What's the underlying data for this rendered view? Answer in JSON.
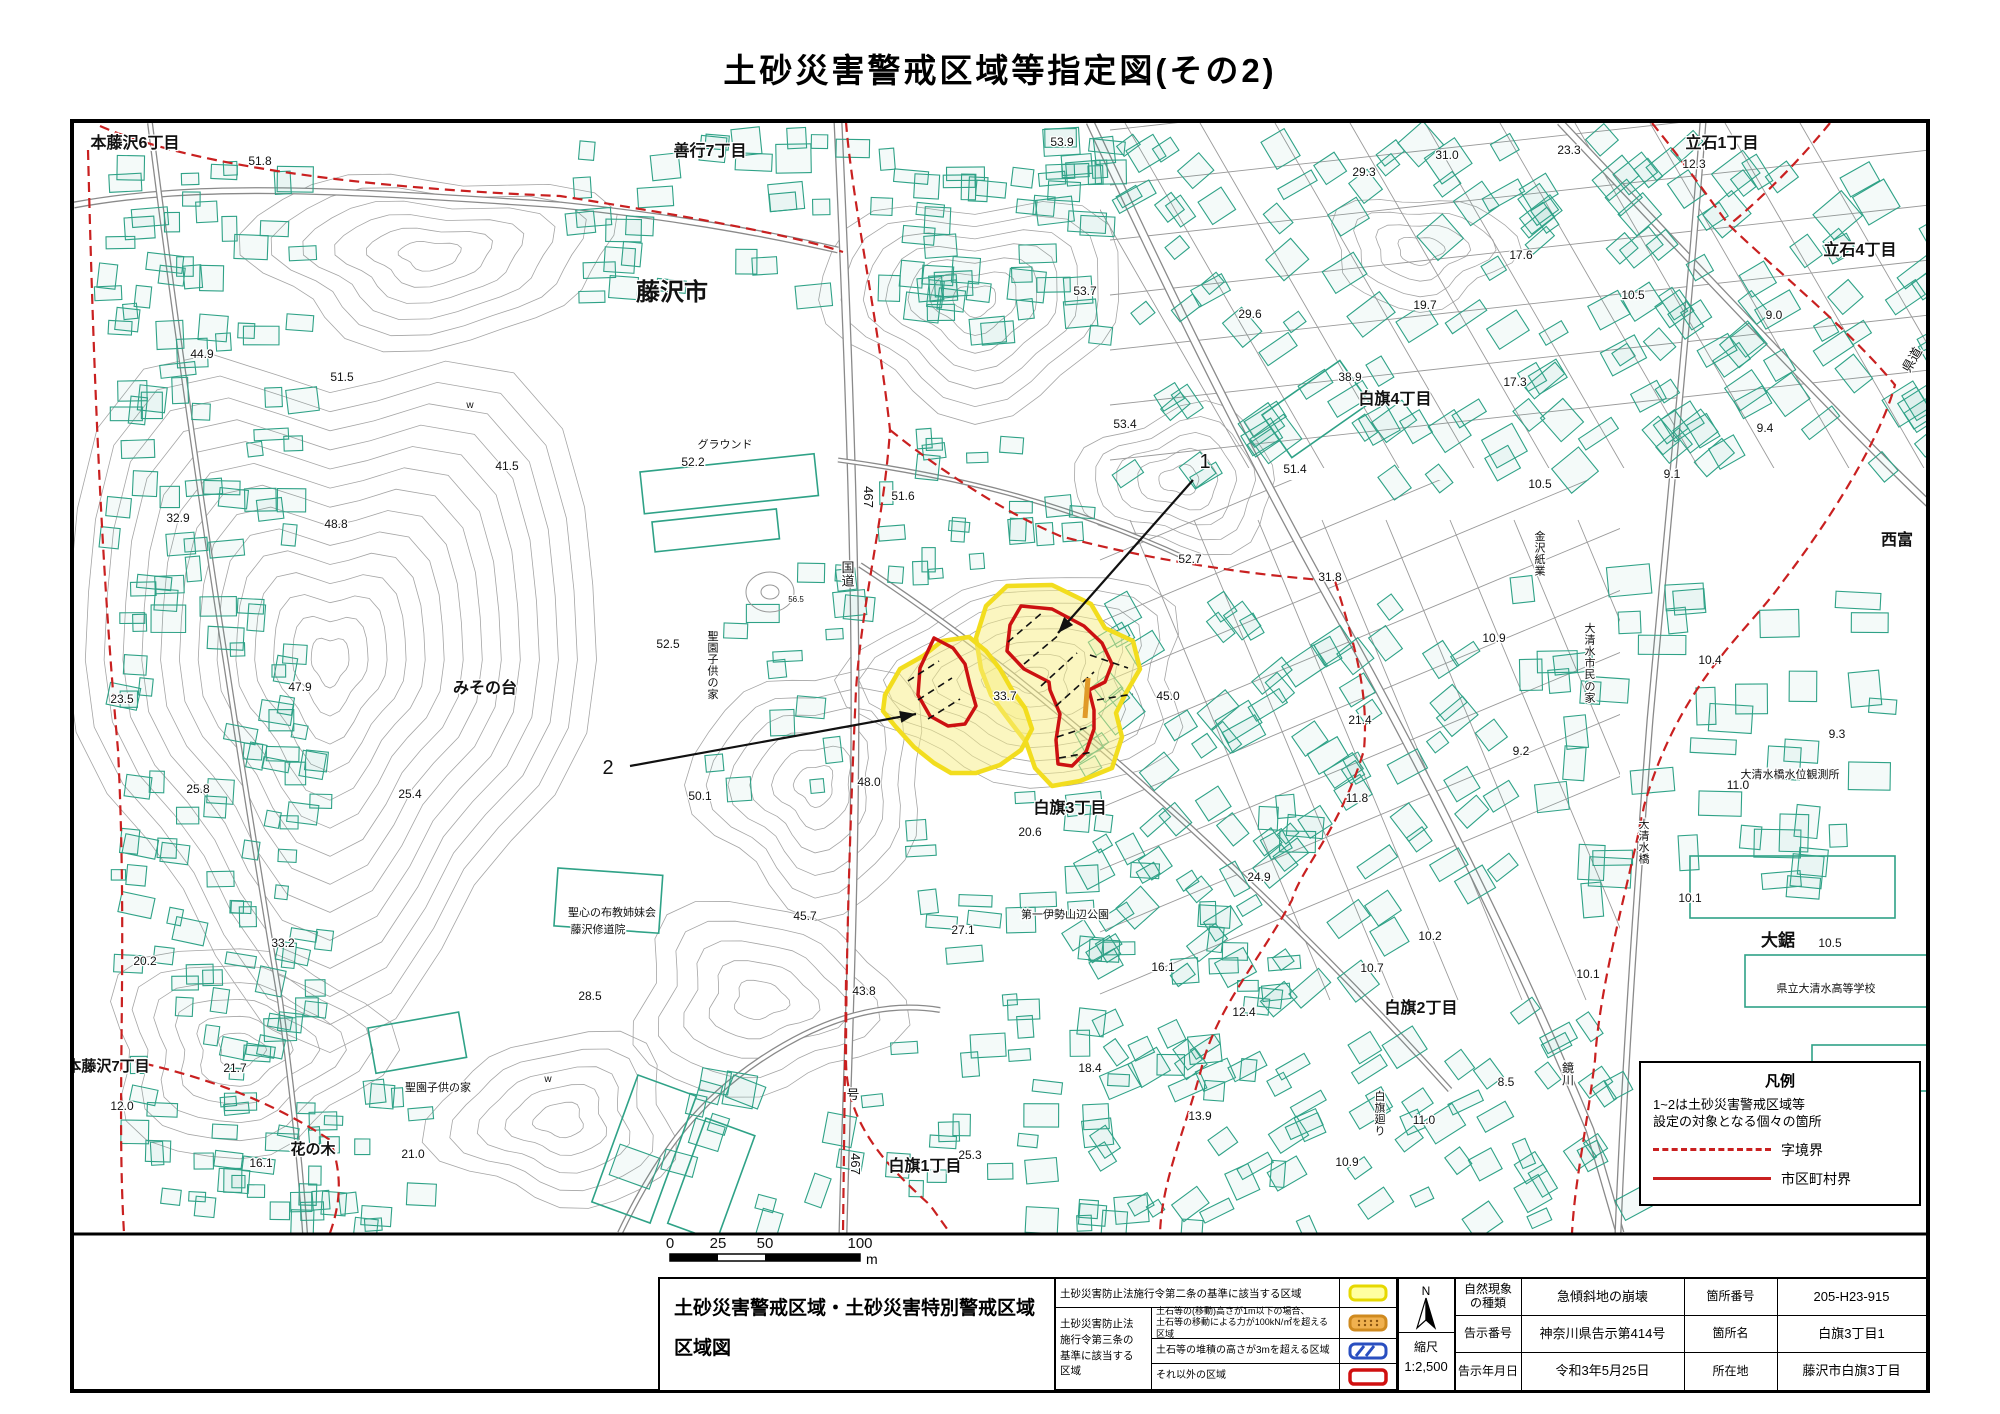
{
  "doc": {
    "title": "土砂災害警戒区域等指定図(その2)"
  },
  "colors": {
    "warning_zone_stroke": "#f2dd1e",
    "warning_zone_fill": "#f7f2c2",
    "special_zone": "#cc1111",
    "boundary_line": "#c92020",
    "building": "#2fa287",
    "contour": "#a5a5a5",
    "road": "#8a8a8a",
    "sediment_mark": "#e09a28",
    "hatch_blue": "#2a4fc0"
  },
  "map": {
    "legend_box": {
      "title": "凡例",
      "note": "1~2は土砂災害警戒区域等\n設定の対象となる個々の箇所",
      "dashed_label": "字境界",
      "solid_label": "市区町村界"
    },
    "scale_bar": {
      "ticks": [
        "0",
        "25",
        "50",
        "100"
      ],
      "unit": "m"
    },
    "texts": [
      {
        "t": "本藤沢6丁目",
        "x": 135,
        "y": 148,
        "s": 16,
        "b": 1
      },
      {
        "t": "善行7丁目",
        "x": 710,
        "y": 156,
        "s": 16,
        "b": 1
      },
      {
        "t": "藤沢市",
        "x": 672,
        "y": 300,
        "s": 24,
        "b": 1
      },
      {
        "t": "立石1丁目",
        "x": 1722,
        "y": 148,
        "s": 16,
        "b": 1
      },
      {
        "t": "立石4丁目",
        "x": 1860,
        "y": 255,
        "s": 16,
        "b": 1
      },
      {
        "t": "白旗4丁目",
        "x": 1395,
        "y": 404,
        "s": 16,
        "b": 1
      },
      {
        "t": "西富",
        "x": 1897,
        "y": 545,
        "s": 16,
        "b": 1
      },
      {
        "t": "みその台",
        "x": 485,
        "y": 693,
        "s": 16,
        "b": 1
      },
      {
        "t": "白旗3丁目",
        "x": 1070,
        "y": 813,
        "s": 16,
        "b": 1
      },
      {
        "t": "白旗2丁目",
        "x": 1421,
        "y": 1013,
        "s": 16,
        "b": 1
      },
      {
        "t": "白旗1丁目",
        "x": 925,
        "y": 1171,
        "s": 16,
        "b": 1
      },
      {
        "t": "本藤沢7丁目",
        "x": 108,
        "y": 1071,
        "s": 15,
        "b": 1
      },
      {
        "t": "花の木",
        "x": 313,
        "y": 1154,
        "s": 15,
        "b": 1
      },
      {
        "t": "大鋸",
        "x": 1778,
        "y": 946,
        "s": 17,
        "b": 1
      },
      {
        "t": "県道",
        "x": 1916,
        "y": 362,
        "s": 13,
        "r": -60
      },
      {
        "t": "グラウンド",
        "x": 725,
        "y": 448,
        "s": 11
      },
      {
        "t": "聖園子供の家",
        "x": 713,
        "y": 640,
        "s": 11,
        "v": 1
      },
      {
        "t": "聖心の布教姉妹会",
        "x": 612,
        "y": 916,
        "s": 11
      },
      {
        "t": "藤沢修道院",
        "x": 598,
        "y": 933,
        "s": 11
      },
      {
        "t": "聖園子供の家",
        "x": 438,
        "y": 1091,
        "s": 11
      },
      {
        "t": "第一伊勢山辺公園",
        "x": 1065,
        "y": 918,
        "s": 11
      },
      {
        "t": "白旗廻り",
        "x": 1380,
        "y": 1100,
        "s": 11,
        "v": 1
      },
      {
        "t": "金沢紙業",
        "x": 1540,
        "y": 540,
        "s": 11,
        "v": 1
      },
      {
        "t": "大清水市民の家",
        "x": 1590,
        "y": 632,
        "s": 11,
        "v": 1
      },
      {
        "t": "大清水橋水位観測所",
        "x": 1790,
        "y": 778,
        "s": 11
      },
      {
        "t": "大清水橋",
        "x": 1644,
        "y": 828,
        "s": 11,
        "v": 1
      },
      {
        "t": "鏡川",
        "x": 1568,
        "y": 1072,
        "s": 12,
        "v": 1
      },
      {
        "t": "県立大清水高等学校",
        "x": 1826,
        "y": 992,
        "s": 11
      },
      {
        "t": "国道",
        "x": 848,
        "y": 572,
        "s": 13,
        "v": 1
      },
      {
        "t": "467",
        "x": 864,
        "y": 497,
        "s": 13,
        "r": 90
      },
      {
        "t": "号",
        "x": 853,
        "y": 1099,
        "s": 13
      },
      {
        "t": "467",
        "x": 851,
        "y": 1164,
        "s": 13,
        "r": 90
      },
      {
        "t": "w",
        "x": 470,
        "y": 408,
        "s": 10
      },
      {
        "t": "w",
        "x": 548,
        "y": 1082,
        "s": 10
      },
      {
        "t": "56.5",
        "x": 796,
        "y": 602,
        "s": 8
      }
    ],
    "elevations": [
      [
        "51.8",
        260,
        165
      ],
      [
        "53.9",
        1062,
        146
      ],
      [
        "31.0",
        1447,
        159
      ],
      [
        "23.3",
        1569,
        154
      ],
      [
        "12.3",
        1694,
        168
      ],
      [
        "29.3",
        1364,
        176
      ],
      [
        "53.7",
        1085,
        295
      ],
      [
        "29.6",
        1250,
        318
      ],
      [
        "19.7",
        1425,
        309
      ],
      [
        "17.6",
        1521,
        259
      ],
      [
        "10.5",
        1633,
        299
      ],
      [
        "9.0",
        1774,
        319
      ],
      [
        "44.9",
        202,
        358
      ],
      [
        "51.5",
        342,
        381
      ],
      [
        "38.9",
        1350,
        381
      ],
      [
        "17.3",
        1515,
        386
      ],
      [
        "9.4",
        1765,
        432
      ],
      [
        "41.5",
        507,
        470
      ],
      [
        "52.2",
        693,
        466
      ],
      [
        "48.8",
        336,
        528
      ],
      [
        "32.9",
        178,
        522
      ],
      [
        "53.4",
        1125,
        428
      ],
      [
        "51.4",
        1295,
        473
      ],
      [
        "9.1",
        1672,
        478
      ],
      [
        "10.5",
        1540,
        488
      ],
      [
        "51.6",
        903,
        500
      ],
      [
        "52.7",
        1190,
        563
      ],
      [
        "31.8",
        1330,
        581
      ],
      [
        "10.9",
        1494,
        642
      ],
      [
        "10.4",
        1710,
        664
      ],
      [
        "52.5",
        668,
        648
      ],
      [
        "23.5",
        122,
        703
      ],
      [
        "47.9",
        300,
        691
      ],
      [
        "33.7",
        1005,
        700
      ],
      [
        "45.0",
        1168,
        700
      ],
      [
        "21.4",
        1360,
        724
      ],
      [
        "9.3",
        1837,
        738
      ],
      [
        "9.2",
        1521,
        755
      ],
      [
        "11.0",
        1738,
        789
      ],
      [
        "25.8",
        198,
        793
      ],
      [
        "25.4",
        410,
        798
      ],
      [
        "48.0",
        869,
        786
      ],
      [
        "50.1",
        700,
        800
      ],
      [
        "20.6",
        1030,
        836
      ],
      [
        "11.8",
        1357,
        802
      ],
      [
        "24.9",
        1259,
        881
      ],
      [
        "10.1",
        1690,
        902
      ],
      [
        "45.7",
        805,
        920
      ],
      [
        "27.1",
        963,
        934
      ],
      [
        "33.2",
        283,
        947
      ],
      [
        "10.2",
        1430,
        940
      ],
      [
        "10.7",
        1372,
        972
      ],
      [
        "16.1",
        1163,
        971
      ],
      [
        "10.5",
        1830,
        947
      ],
      [
        "10.1",
        1588,
        978
      ],
      [
        "28.5",
        590,
        1000
      ],
      [
        "43.8",
        864,
        995
      ],
      [
        "12.4",
        1244,
        1016
      ],
      [
        "20.2",
        145,
        965
      ],
      [
        "11.0",
        1424,
        1124
      ],
      [
        "8.5",
        1506,
        1086
      ],
      [
        "13.9",
        1200,
        1120
      ],
      [
        "10.9",
        1347,
        1166
      ],
      [
        "21.7",
        235,
        1072
      ],
      [
        "12.0",
        122,
        1110
      ],
      [
        "16.1",
        261,
        1167
      ],
      [
        "21.0",
        413,
        1158
      ],
      [
        "25.3",
        970,
        1159
      ],
      [
        "18.4",
        1090,
        1072
      ]
    ],
    "hazard_points": [
      {
        "label": "1",
        "lx": 1205,
        "ly": 468,
        "x1": 1193,
        "y1": 480,
        "x2": 1058,
        "y2": 633
      },
      {
        "label": "2",
        "lx": 608,
        "ly": 774,
        "x1": 630,
        "y1": 766,
        "x2": 916,
        "y2": 714
      }
    ]
  },
  "footer": {
    "block_title_line1": "土砂災害警戒区域・土砂災害特別警戒区域",
    "block_title_line2": "区域図",
    "legend": {
      "row1_label": "土砂災害防止法施行令第二条の基準に該当する区域",
      "group_label": "土砂災害防止法\n施行令第三条の\n基準に該当する\n区域",
      "row2_label": "土石等の(移動)高さが1m以下の場合、\n土石等の移動による力が100kN/㎡を超える区域",
      "row3_label": "土石等の堆積の高さが3mを超える区域",
      "row4_label": "それ以外の区域"
    },
    "compass": {
      "north": "N",
      "scale_label": "縮尺",
      "scale_value": "1:2,500"
    },
    "info": {
      "rows": [
        {
          "label1": "自然現象\nの種類",
          "value1": "急傾斜地の崩壊",
          "label2": "箇所番号",
          "value2": "205-H23-915"
        },
        {
          "label1": "告示番号",
          "value1": "神奈川県告示第414号",
          "label2": "箇所名",
          "value2": "白旗3丁目1"
        },
        {
          "label1": "告示年月日",
          "value1": "令和3年5月25日",
          "label2": "所在地",
          "value2": "藤沢市白旗3丁目"
        }
      ]
    }
  }
}
